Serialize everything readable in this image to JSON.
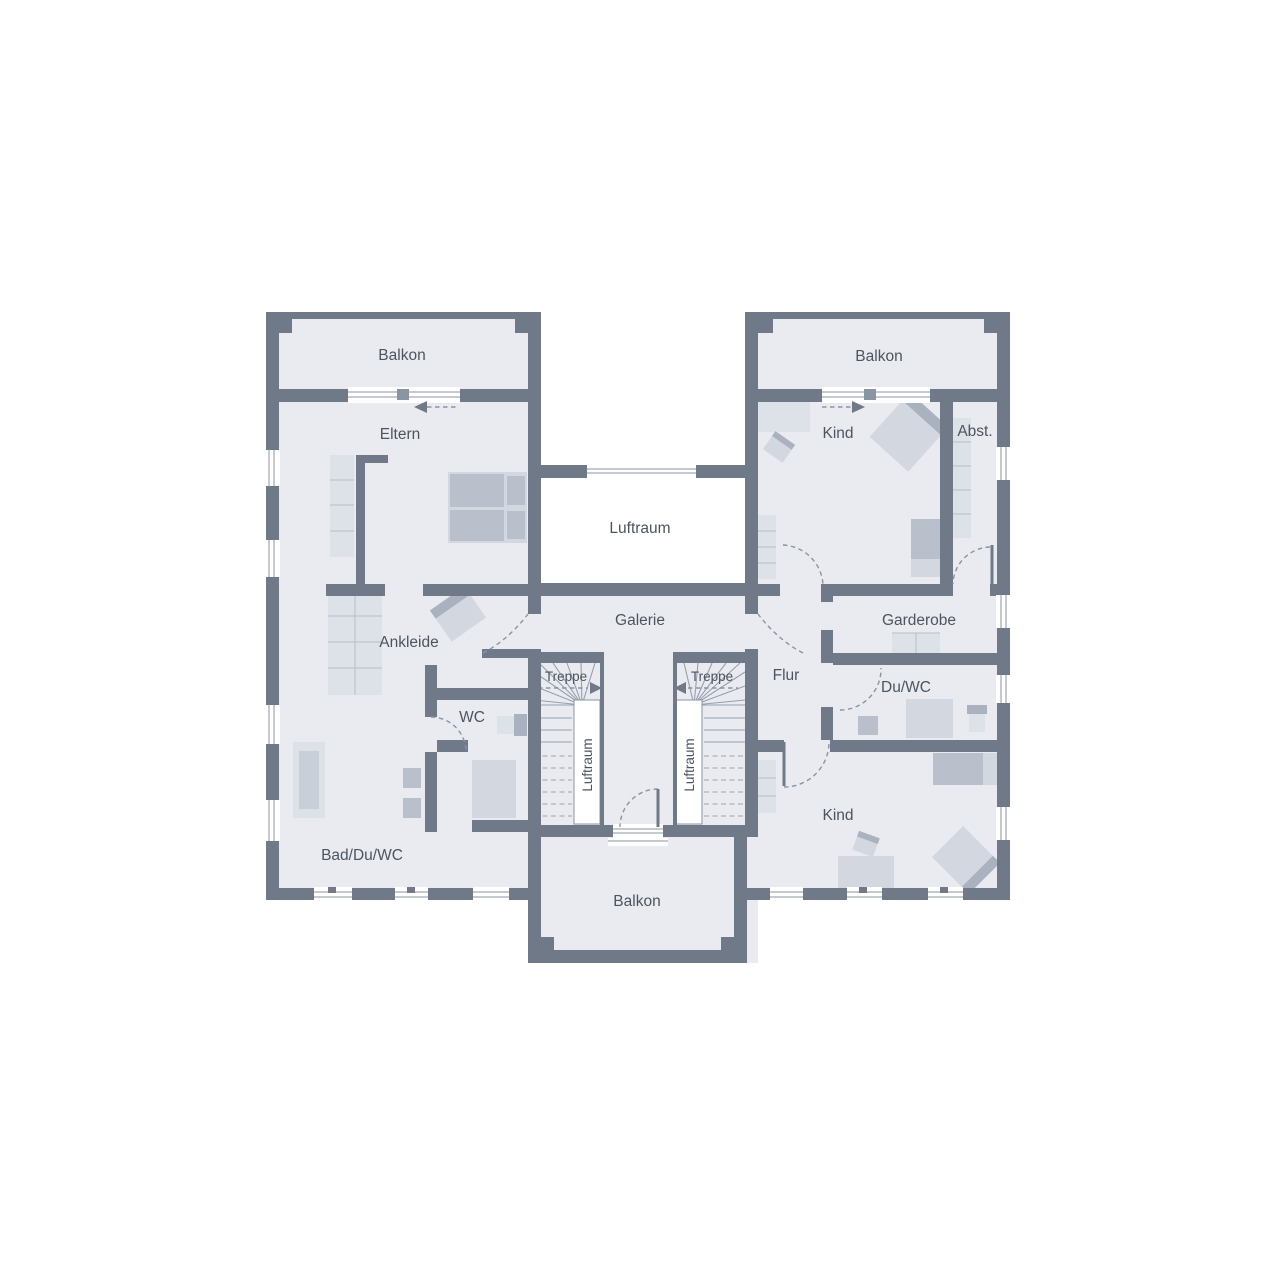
{
  "plan_type": "floor-plan",
  "labels": {
    "balkon_top_left": "Balkon",
    "balkon_top_right": "Balkon",
    "balkon_bottom": "Balkon",
    "eltern": "Eltern",
    "kind_top": "Kind",
    "kind_bottom": "Kind",
    "abstellraum": "Abst.",
    "luftraum": "Luftraum",
    "luftraum_stair_left": "Luftraum",
    "luftraum_stair_right": "Luftraum",
    "galerie": "Galerie",
    "garderobe": "Garderobe",
    "flur": "Flur",
    "du_wc": "Du/WC",
    "wc": "WC",
    "ankleide": "Ankleide",
    "bad_du_wc": "Bad/Du/WC",
    "treppe_left": "Treppe",
    "treppe_right": "Treppe"
  },
  "colors": {
    "wall": "#6f7987",
    "floor": "#e9ebf1",
    "void": "#ffffff",
    "furniture_light": "#dde1e8",
    "furniture_mid": "#d3d8e0",
    "furniture_dark": "#aab2bf",
    "line": "#8b94a2",
    "text": "#4d5460"
  }
}
